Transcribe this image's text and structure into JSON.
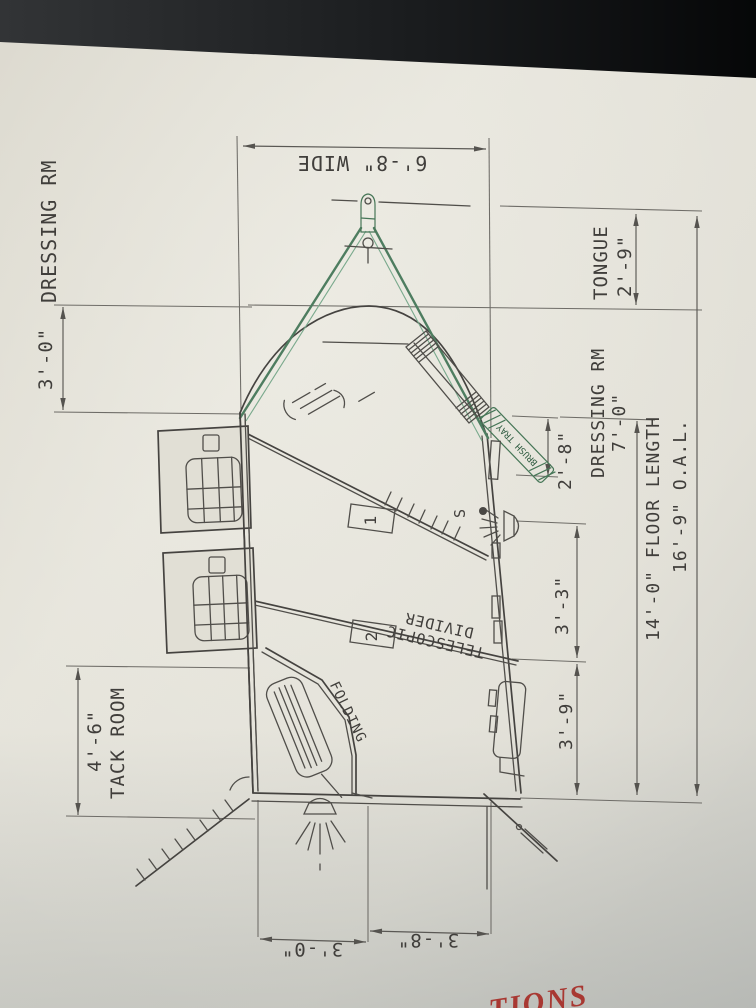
{
  "drawing": {
    "dimensions": {
      "width": "6'-8\" WIDE",
      "dressing_room_front": "3'-0\"",
      "dressing_room_side_label": "DRESSING RM",
      "tongue_label": "TONGUE",
      "tongue_length": "2'-9\"",
      "dressing_room_label": "DRESSING RM",
      "dressing_room_length": "7'-0\"",
      "nose_depth": "2'-8\"",
      "floor_length": "14'-0\" FLOOR LENGTH",
      "overall_length": "16'-9\" O.A.L.",
      "stall_1_width": "3'-3\"",
      "stall_2_width": "3'-9\"",
      "tack_room_label": "TACK ROOM",
      "tack_room_length": "4'-6\"",
      "rear_left_width": "3'-0\"",
      "rear_right_width": "3'-8\""
    },
    "annotations": {
      "divider_line_1": "TELESCOPIC",
      "divider_line_2": "DIVIDER",
      "folding_label": "FOLDING",
      "brush_tray_label": "BRUSH TRAY",
      "stall_1_number": "1",
      "stall_2_number": "2",
      "light_switch": "S"
    },
    "colors": {
      "paper": "#e3e1d8",
      "bezel": "#17191b",
      "line": "#4f4d4a",
      "hitch_green": "#4e7d60",
      "brush_tray_green": "#2f5c41",
      "red_text": "#a83832"
    }
  },
  "overlay_text": {
    "red_partial": "TIONS"
  }
}
